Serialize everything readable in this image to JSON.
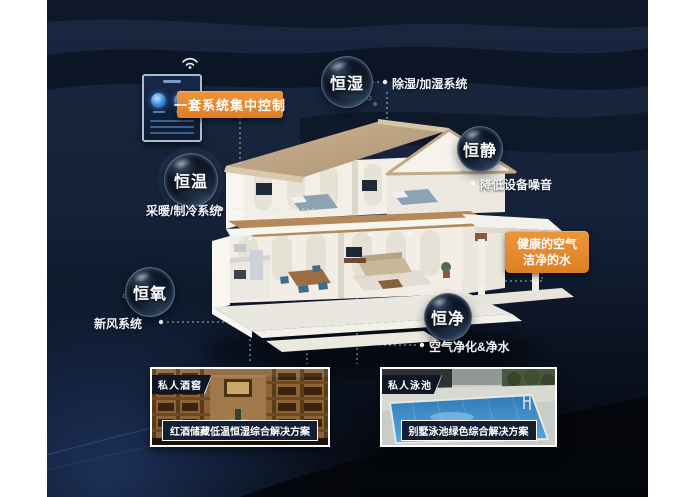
{
  "colors": {
    "accent_orange": "#E2872E",
    "background_navy": "#16243E",
    "text_white": "#FFFFFF"
  },
  "control_panel": {
    "label": "一套系统集中控制",
    "wifi_icon": "wifi"
  },
  "bubbles": [
    {
      "name": "恒湿",
      "note": "除湿/加湿系统"
    },
    {
      "name": "恒静",
      "note": "降低设备噪音"
    },
    {
      "name": "恒温",
      "note": "采暖/制冷系统"
    },
    {
      "name": "恒氧",
      "note": "新风系统"
    },
    {
      "name": "恒净",
      "note": "空气净化&净水"
    }
  ],
  "highlight_box": {
    "line1": "健康的空气",
    "line2": "洁净的水"
  },
  "photos": [
    {
      "tag": "私人酒窖",
      "caption": "红酒储藏低温恒湿综合解决方案"
    },
    {
      "tag": "私人泳池",
      "caption": "别墅泳池绿色综合解决方案"
    }
  ]
}
